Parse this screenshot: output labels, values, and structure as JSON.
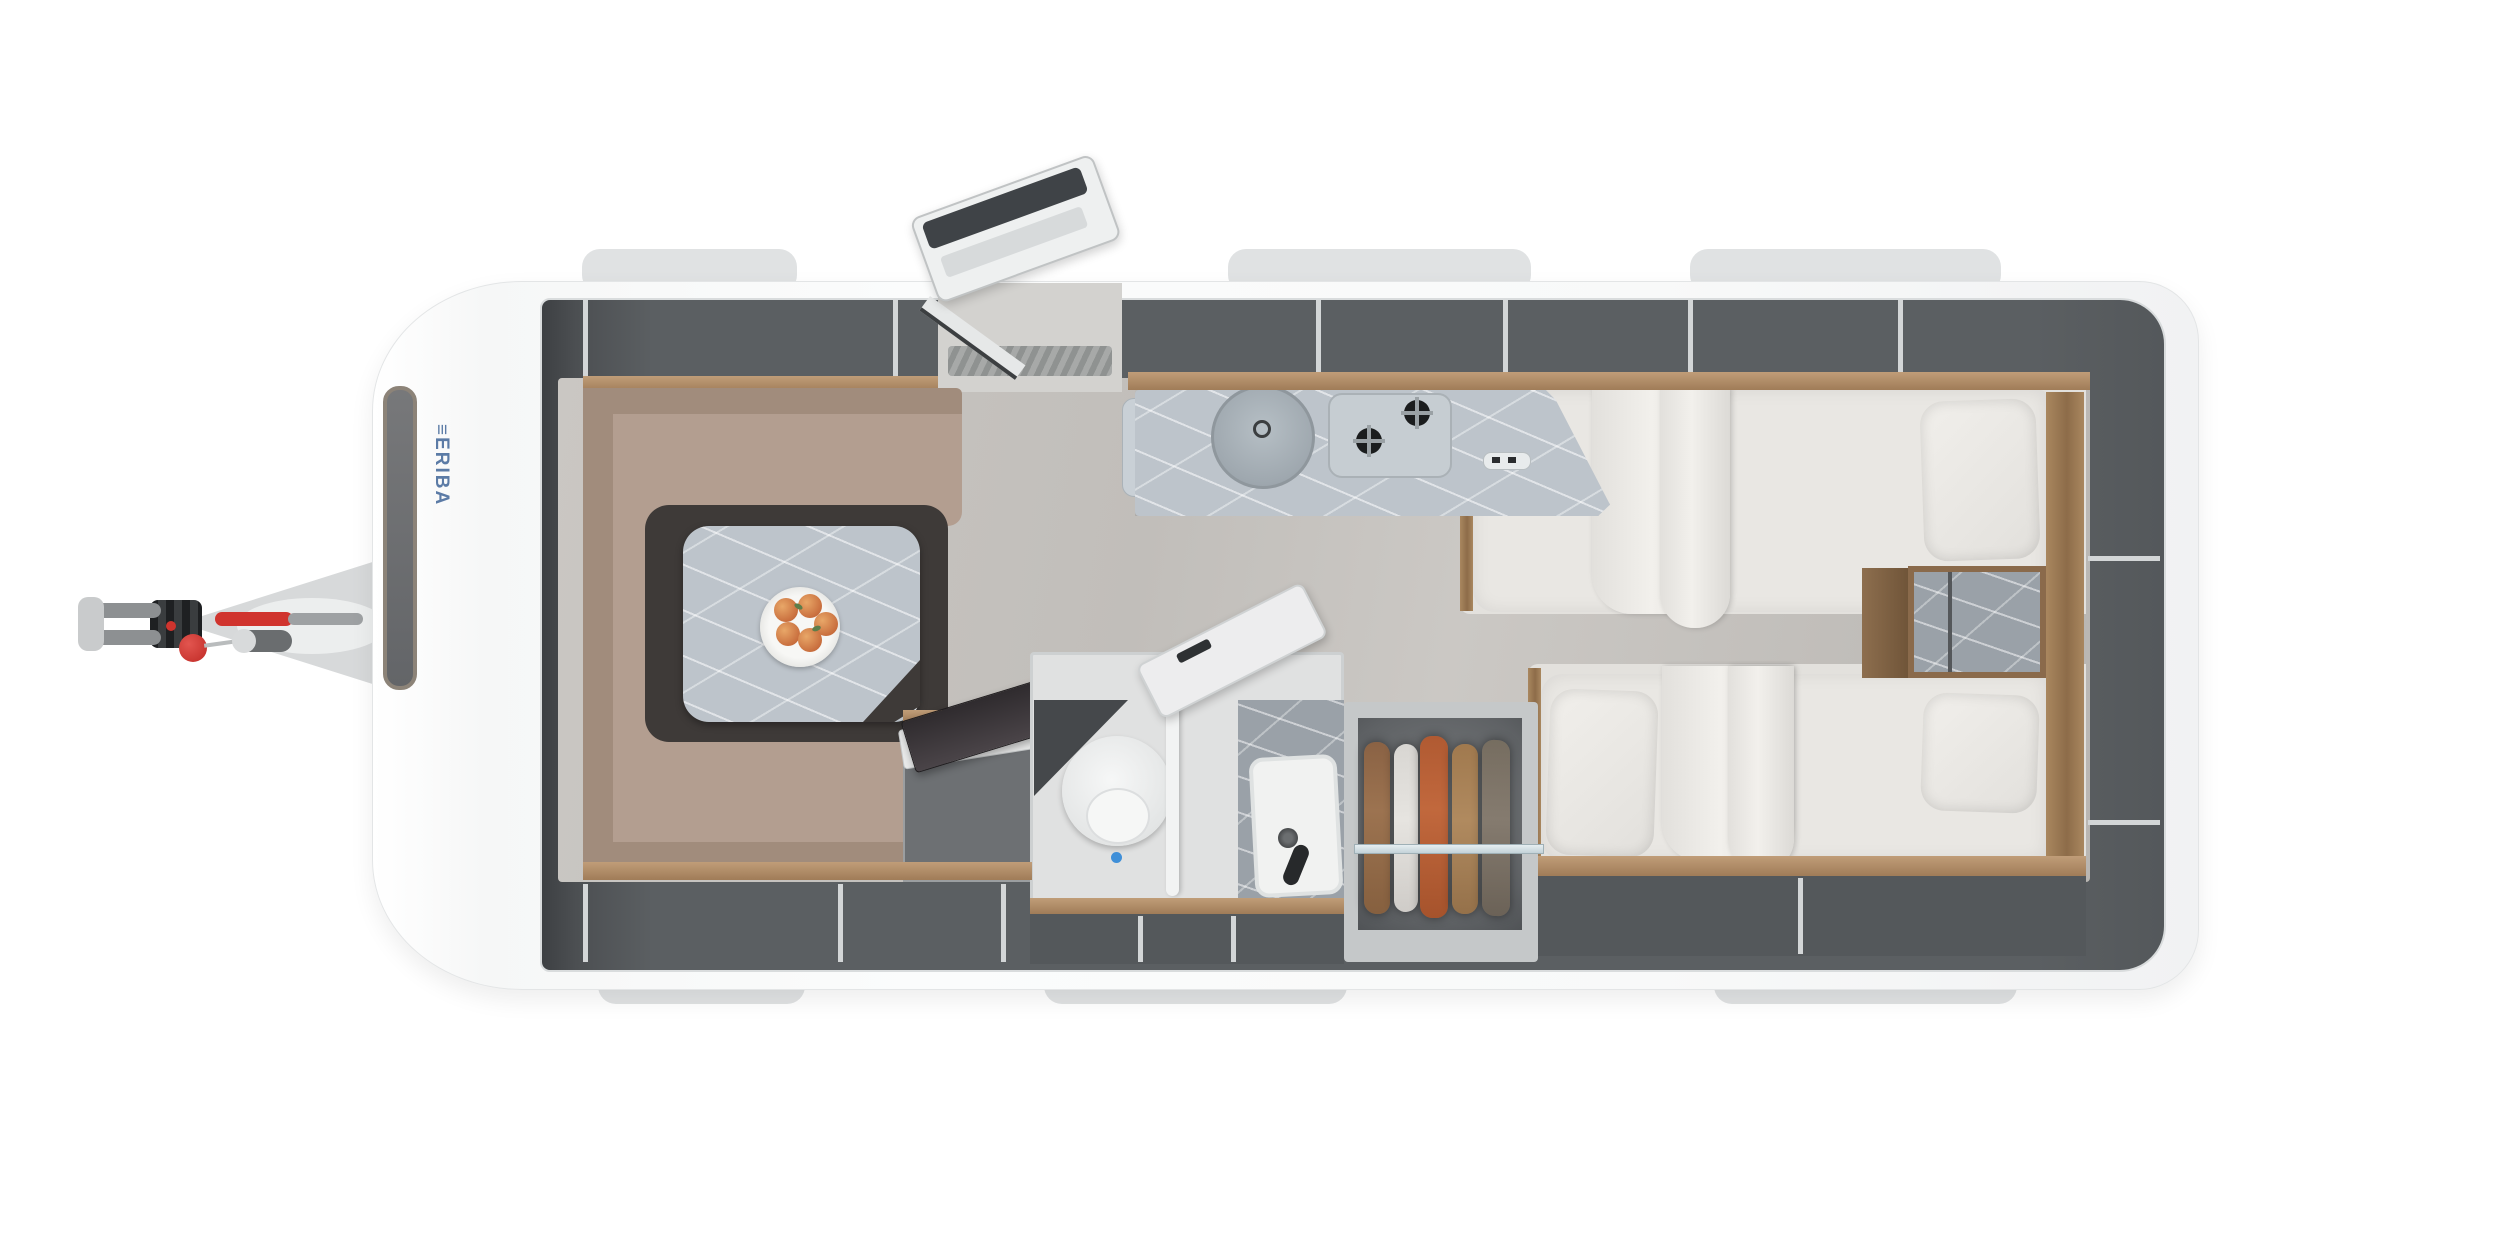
{
  "scene": {
    "type": "caravan-floorplan-top-view",
    "background": "#ffffff"
  },
  "brand": {
    "mark": "≡",
    "logo": "ERIBA",
    "logo_color": "#5b7ba6"
  },
  "palette": {
    "shell_white": "#fbfcfc",
    "wall_gray": "#d9dcdd",
    "locker_dark": "#5b5f62",
    "wood": "#b3906c",
    "floor": "#c6c3bf",
    "sofa_fabric": "#b39e90",
    "marble_light": "#bdc4cb",
    "marble_dark": "#9aa1a8",
    "mattress_white": "#e9e7e3",
    "hitch_red": "#d0342e",
    "flush_blue": "#3f8fd8",
    "fruit_orange": "#c96f3e",
    "clothes": [
      "#9c7350",
      "#e6e4e0",
      "#c1683d",
      "#b08a5f",
      "#857b6f"
    ]
  },
  "features": {
    "hitch": "tow-hitch-with-handbrake-and-jockey-wheel",
    "dinette": "u-shaped-lounge-with-pedestal-table",
    "entry_door": "open-entry-door",
    "kitchen": "kitchenette-round-sink-two-burner-hob",
    "bathroom": "washroom-toilet-and-shower",
    "wardrobe": "wardrobe-with-hanging-clothes",
    "beds": "twin-single-beds-with-bedside-chest"
  }
}
